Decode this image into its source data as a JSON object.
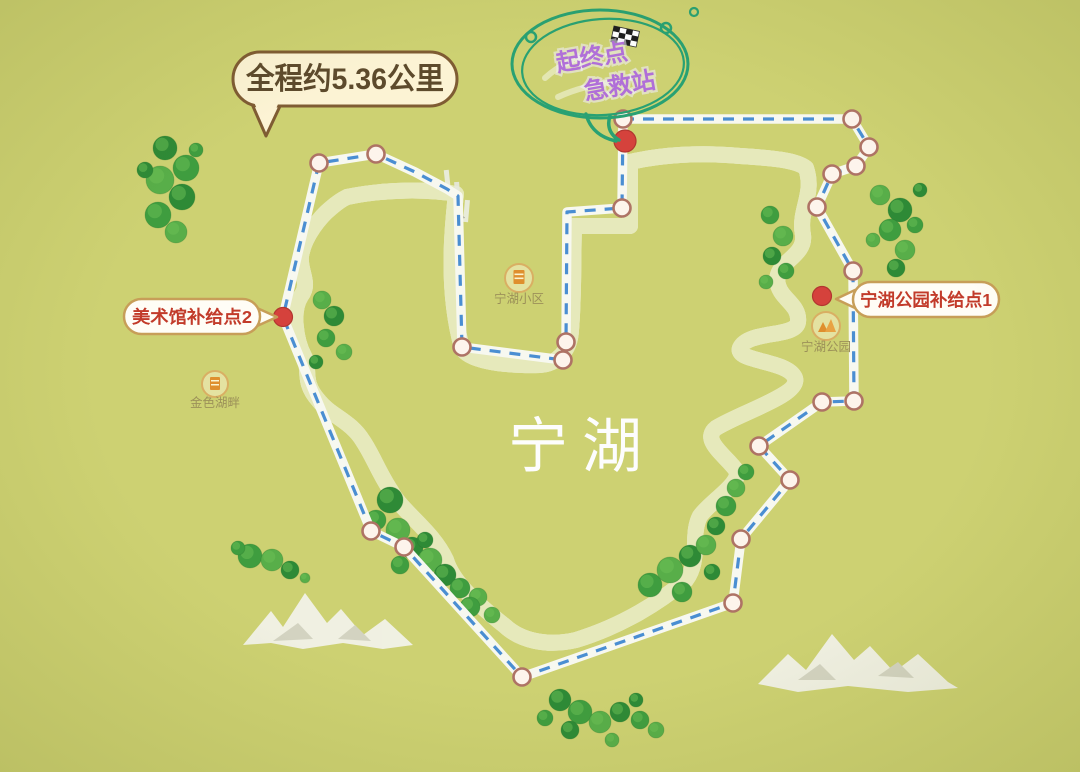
{
  "map": {
    "lake_name": "宁湖",
    "distance_bubble": {
      "text": "全程约5.36公里"
    },
    "start_balloon": {
      "line1": "起终点",
      "line2": "急救站"
    },
    "supply_labels": {
      "supply2": {
        "text": "美术馆补给点2"
      },
      "supply1": {
        "text": "宁湖公园补给点1"
      }
    },
    "pois": {
      "jinse_hupan": {
        "label": "金色湖畔"
      },
      "ninghu_xiaoqu": {
        "label": "宁湖小区"
      },
      "ninghu_gongyuan": {
        "label": "宁湖公园"
      }
    },
    "colors": {
      "land": "#cdd172",
      "lake": "#4187c6",
      "shore": "#342318",
      "route_dash": "#4a8ed2",
      "balloon_green": "#29a173",
      "balloon_purple": "#b06fd8",
      "label_red": "#c23b2a",
      "bubble_cream": "#fcf3d4",
      "bubble_border": "#7f5c33",
      "marker_red": "#d5423c"
    },
    "route": {
      "points": [
        [
          623,
          119
        ],
        [
          852,
          119
        ],
        [
          869,
          147
        ],
        [
          856,
          166
        ],
        [
          832,
          174
        ],
        [
          817,
          207
        ],
        [
          853,
          271
        ],
        [
          854,
          401
        ],
        [
          822,
          402
        ],
        [
          759,
          446
        ],
        [
          790,
          480
        ],
        [
          741,
          539
        ],
        [
          733,
          603
        ],
        [
          522,
          677
        ],
        [
          404,
          547
        ],
        [
          371,
          531
        ],
        [
          283,
          317
        ],
        [
          319,
          163
        ],
        [
          376,
          154
        ],
        [
          415,
          172
        ],
        [
          447,
          189
        ],
        [
          458,
          196
        ],
        [
          462,
          347
        ],
        [
          563,
          360
        ],
        [
          566,
          342
        ],
        [
          567,
          212
        ],
        [
          622,
          208
        ]
      ],
      "waypoints": [
        [
          623,
          119
        ],
        [
          852,
          119
        ],
        [
          869,
          147
        ],
        [
          856,
          166
        ],
        [
          832,
          174
        ],
        [
          817,
          207
        ],
        [
          853,
          271
        ],
        [
          854,
          401
        ],
        [
          822,
          402
        ],
        [
          759,
          446
        ],
        [
          790,
          480
        ],
        [
          741,
          539
        ],
        [
          733,
          603
        ],
        [
          522,
          677
        ],
        [
          404,
          547
        ],
        [
          371,
          531
        ],
        [
          319,
          163
        ],
        [
          376,
          154
        ],
        [
          462,
          347
        ],
        [
          563,
          360
        ],
        [
          566,
          342
        ],
        [
          622,
          208
        ]
      ],
      "markers": [
        {
          "type": "start-finish",
          "x": 625,
          "y": 141,
          "r": 11
        },
        {
          "type": "supply-point-2",
          "x": 283,
          "y": 317,
          "r": 9.5
        },
        {
          "type": "supply-point-1",
          "x": 822,
          "y": 296,
          "r": 9.5
        }
      ]
    },
    "trees": [
      [
        165,
        148,
        12
      ],
      [
        186,
        168,
        13
      ],
      [
        160,
        180,
        14
      ],
      [
        182,
        197,
        13
      ],
      [
        158,
        215,
        13
      ],
      [
        176,
        232,
        11
      ],
      [
        145,
        170,
        8
      ],
      [
        196,
        150,
        7
      ],
      [
        322,
        300,
        9
      ],
      [
        334,
        316,
        10
      ],
      [
        326,
        338,
        9
      ],
      [
        344,
        352,
        8
      ],
      [
        316,
        362,
        7
      ],
      [
        250,
        556,
        12
      ],
      [
        272,
        560,
        11
      ],
      [
        290,
        570,
        9
      ],
      [
        238,
        548,
        7
      ],
      [
        305,
        578,
        5
      ],
      [
        390,
        500,
        13
      ],
      [
        376,
        520,
        10
      ],
      [
        398,
        530,
        12
      ],
      [
        412,
        548,
        11
      ],
      [
        400,
        565,
        9
      ],
      [
        430,
        560,
        12
      ],
      [
        445,
        575,
        11
      ],
      [
        460,
        588,
        10
      ],
      [
        478,
        597,
        9
      ],
      [
        425,
        540,
        8
      ],
      [
        470,
        607,
        10
      ],
      [
        492,
        615,
        8
      ],
      [
        560,
        700,
        11
      ],
      [
        580,
        712,
        12
      ],
      [
        600,
        722,
        11
      ],
      [
        620,
        712,
        10
      ],
      [
        640,
        720,
        9
      ],
      [
        656,
        730,
        8
      ],
      [
        570,
        730,
        9
      ],
      [
        545,
        718,
        8
      ],
      [
        612,
        740,
        7
      ],
      [
        636,
        700,
        7
      ],
      [
        650,
        585,
        12
      ],
      [
        670,
        570,
        13
      ],
      [
        690,
        556,
        11
      ],
      [
        682,
        592,
        10
      ],
      [
        706,
        545,
        10
      ],
      [
        716,
        526,
        9
      ],
      [
        726,
        506,
        10
      ],
      [
        736,
        488,
        9
      ],
      [
        712,
        572,
        8
      ],
      [
        746,
        472,
        8
      ],
      [
        880,
        195,
        10
      ],
      [
        900,
        210,
        12
      ],
      [
        890,
        230,
        11
      ],
      [
        905,
        250,
        10
      ],
      [
        896,
        268,
        9
      ],
      [
        915,
        225,
        8
      ],
      [
        873,
        240,
        7
      ],
      [
        920,
        190,
        7
      ],
      [
        770,
        215,
        9
      ],
      [
        783,
        236,
        10
      ],
      [
        772,
        256,
        9
      ],
      [
        786,
        271,
        8
      ],
      [
        766,
        282,
        7
      ]
    ]
  }
}
